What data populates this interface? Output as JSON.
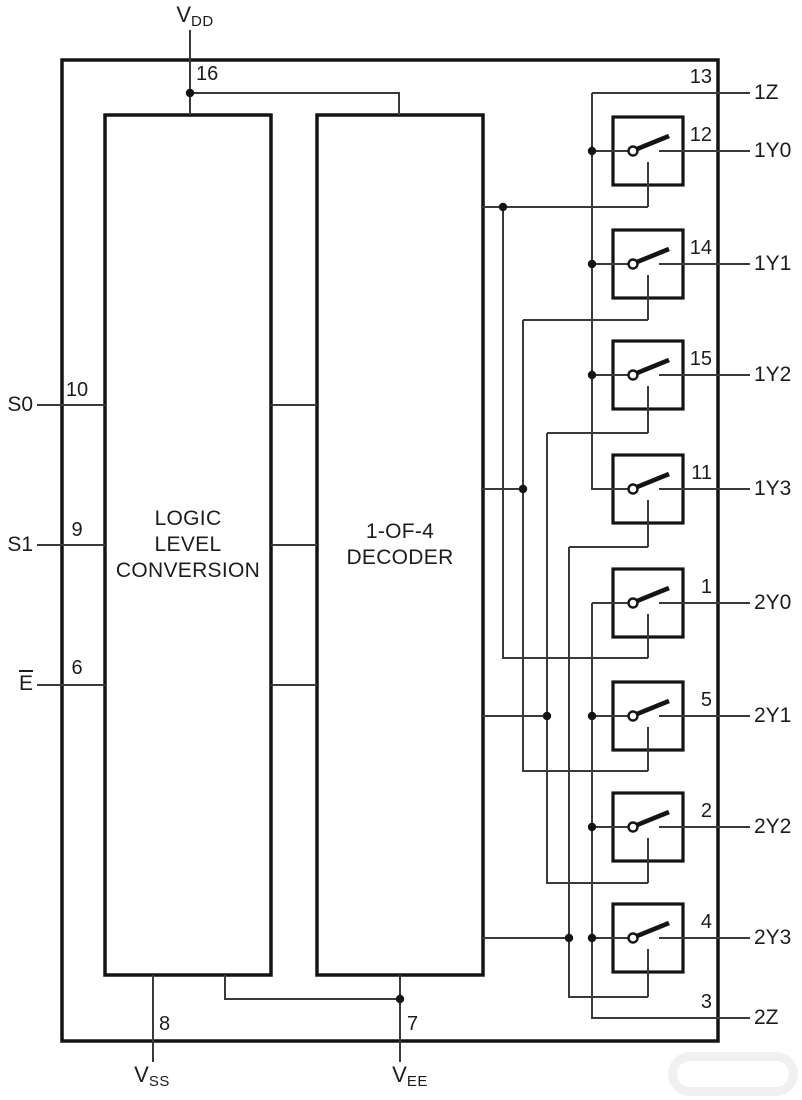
{
  "ic": {
    "power": {
      "vdd": {
        "name": "V",
        "sub": "DD",
        "pin": "16"
      },
      "vss": {
        "name": "V",
        "sub": "SS",
        "pin": "8"
      },
      "vee": {
        "name": "V",
        "sub": "EE",
        "pin": "7"
      }
    },
    "left_inputs": [
      {
        "label": "S0",
        "pin": "10"
      },
      {
        "label": "S1",
        "pin": "9"
      },
      {
        "label": "E",
        "overbar": true,
        "pin": "6"
      }
    ],
    "blocks": {
      "logic": {
        "lines": [
          "LOGIC",
          "LEVEL",
          "CONVERSION"
        ]
      },
      "decoder": {
        "lines": [
          "1-OF-4",
          "DECODER"
        ]
      }
    },
    "channels": [
      {
        "z": {
          "label": "1Z",
          "pin": "13"
        },
        "switches": [
          {
            "label": "1Y0",
            "pin": "12"
          },
          {
            "label": "1Y1",
            "pin": "14"
          },
          {
            "label": "1Y2",
            "pin": "15"
          },
          {
            "label": "1Y3",
            "pin": "11"
          }
        ]
      },
      {
        "z": {
          "label": "2Z",
          "pin": "3"
        },
        "switches": [
          {
            "label": "2Y0",
            "pin": "1"
          },
          {
            "label": "2Y1",
            "pin": "5"
          },
          {
            "label": "2Y2",
            "pin": "2"
          },
          {
            "label": "2Y3",
            "pin": "4"
          }
        ]
      }
    ],
    "colors": {
      "wire": "#3a3a3a",
      "box": "#141414",
      "text": "#1c1c1c",
      "background": "#ffffff"
    }
  }
}
